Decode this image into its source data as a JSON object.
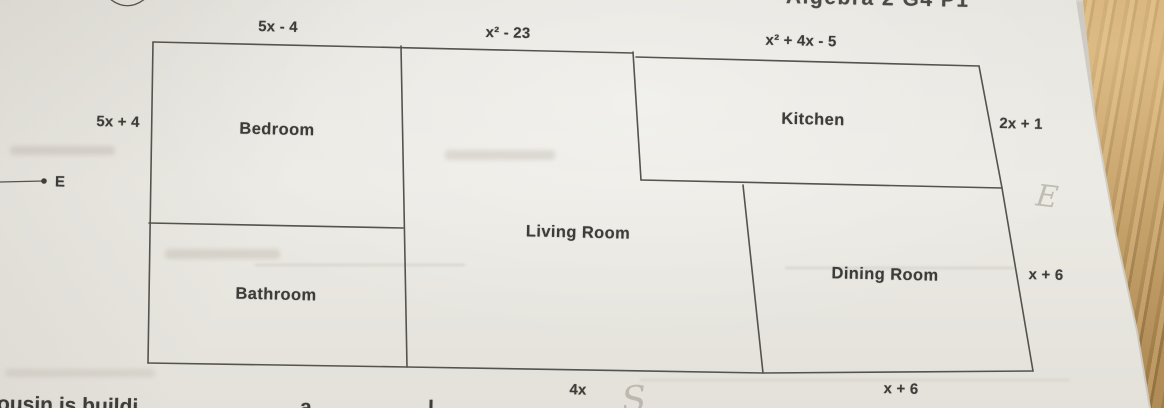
{
  "page": {
    "header_title": "Algebra 2 G4 P1",
    "bottom_text_fragments": {
      "f1": "ousin is buildi",
      "f2": "a",
      "f3": "l"
    }
  },
  "floor_plan": {
    "point_label": "E",
    "rooms": {
      "bedroom": "Bedroom",
      "bathroom": "Bathroom",
      "living": "Living Room",
      "kitchen": "Kitchen",
      "dining": "Dining Room"
    },
    "dimensions": {
      "bedroom_top": "5x - 4",
      "living_top": "x² - 23",
      "kitchen_top": "x² + 4x - 5",
      "bedroom_left": "5x + 4",
      "kitchen_right": "2x + 1",
      "dining_right": "x + 6",
      "living_bottom": "4x",
      "dining_bottom": "x + 6"
    }
  },
  "annotations": {
    "pencil_mark_right": "E",
    "pencil_mark_bottom": "S"
  },
  "colors": {
    "paper": "#eae8e2",
    "ink": "#3d3c39",
    "wall_line": "#55534e",
    "pencil": "#9e9789",
    "wood": "#b08b54"
  }
}
